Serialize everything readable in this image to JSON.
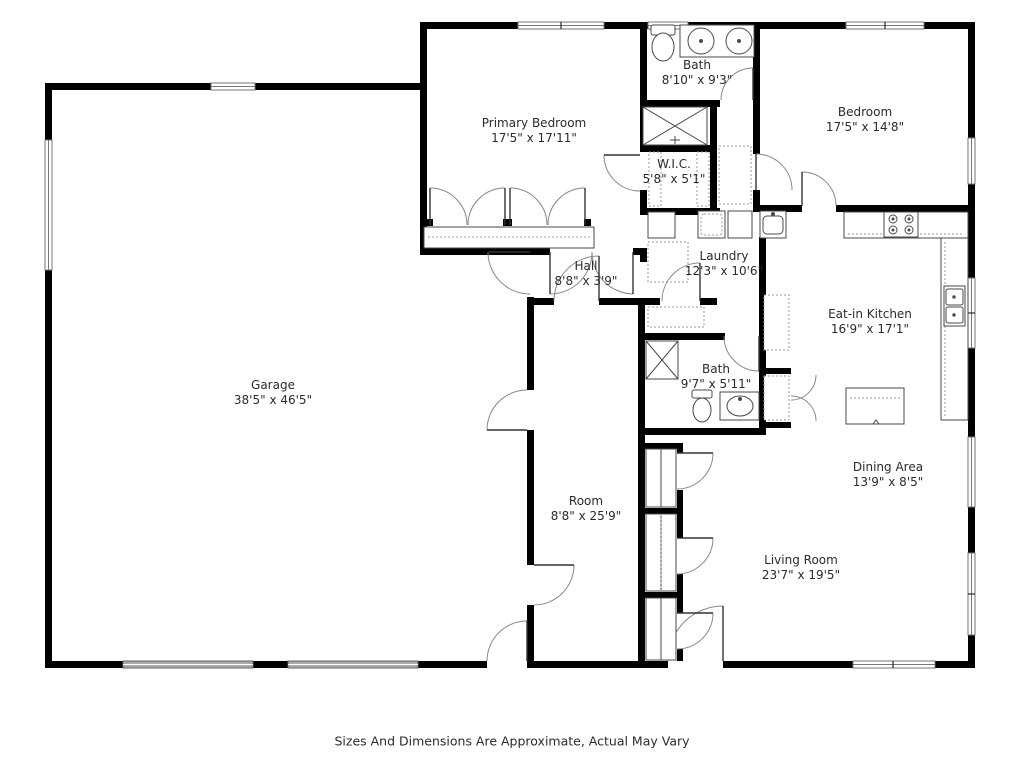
{
  "title": "Floor Plan",
  "colors": {
    "wall": "#000000",
    "background": "#ffffff",
    "fixture_stroke": "#4a4a4a",
    "door_arc": "#777777",
    "window_fill": "#ffffff",
    "garage_door_fill": "#aaaaaa",
    "label_text": "#2b2b2b"
  },
  "rooms": [
    {
      "id": "bath-1",
      "name": "Bath",
      "dims": "8'10\" x 9'3\""
    },
    {
      "id": "primary-bedroom",
      "name": "Primary Bedroom",
      "dims": "17'5\" x 17'11\""
    },
    {
      "id": "bedroom",
      "name": "Bedroom",
      "dims": "17'5\" x 14'8\""
    },
    {
      "id": "wic",
      "name": "W.I.C.",
      "dims": "5'8\" x 5'1\""
    },
    {
      "id": "hall",
      "name": "Hall",
      "dims": "8'8\" x 3'9\""
    },
    {
      "id": "laundry",
      "name": "Laundry",
      "dims": "12'3\" x 10'6\""
    },
    {
      "id": "eat-in-kitchen",
      "name": "Eat-in Kitchen",
      "dims": "16'9\" x 17'1\""
    },
    {
      "id": "garage",
      "name": "Garage",
      "dims": "38'5\" x 46'5\""
    },
    {
      "id": "bath-2",
      "name": "Bath",
      "dims": "9'7\" x 5'11\""
    },
    {
      "id": "dining-area",
      "name": "Dining Area",
      "dims": "13'9\" x 8'5\""
    },
    {
      "id": "room",
      "name": "Room",
      "dims": "8'8\" x 25'9\""
    },
    {
      "id": "living-room",
      "name": "Living Room",
      "dims": "23'7\" x 19'5\""
    }
  ],
  "footer": {
    "text": "Sizes And Dimensions Are Approximate, Actual May Vary"
  }
}
